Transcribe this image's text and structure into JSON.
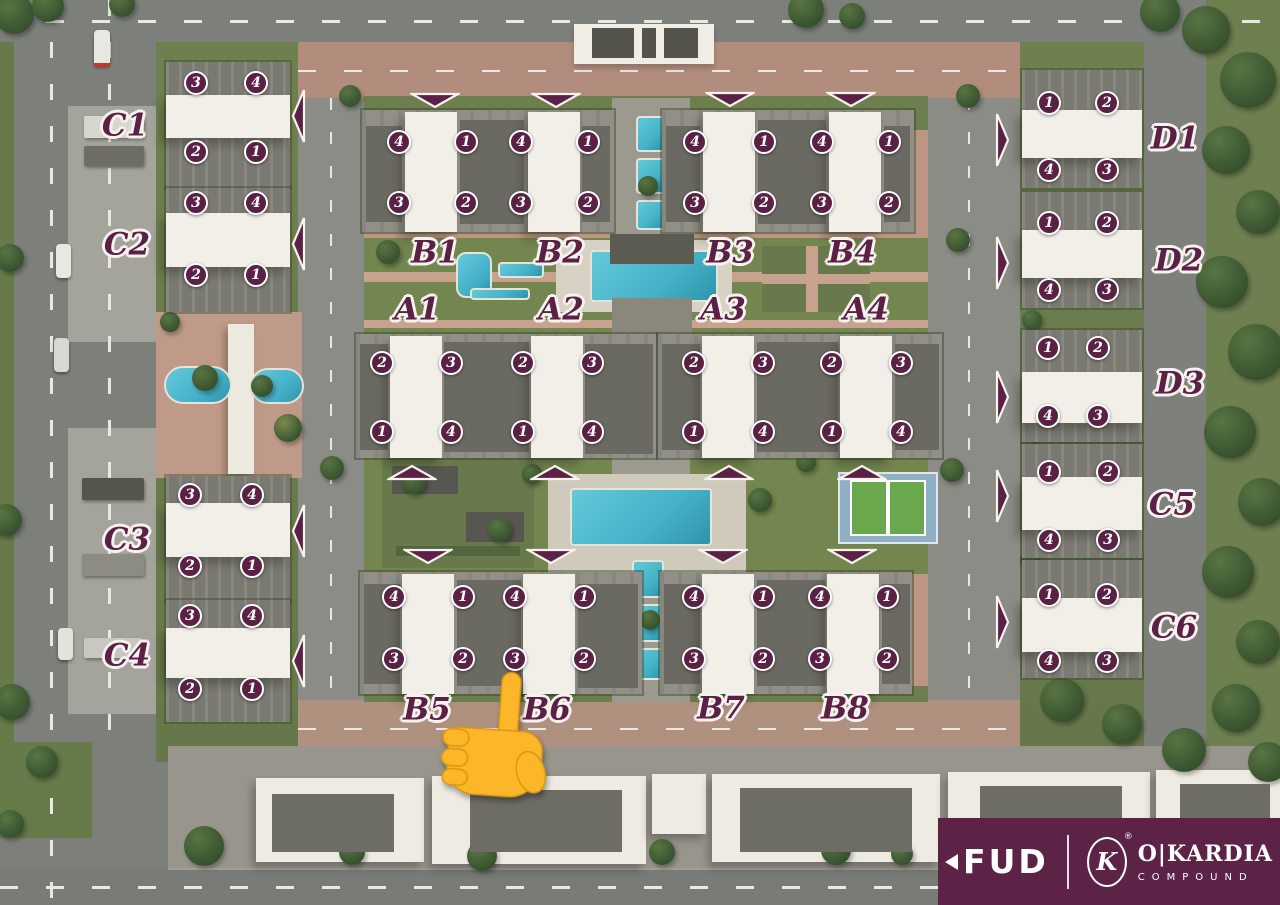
{
  "title": "O|Kardia Compound site master plan",
  "colors": {
    "marker_bg": "#5a2145",
    "marker_text": "#ffffff",
    "label_text": "#5b2045",
    "label_outline": "#f6f3ee",
    "arrow_fill": "#5b2045",
    "arrow_outline": "#f6f3ee",
    "logo_bg": "#5c2347",
    "pointer_yellow": "#fbb629",
    "pool_water": "#45b2c8",
    "lawn_green": "#74864f",
    "tennis_green": "#69a84d",
    "tennis_apron_blue": "#8fb0c4",
    "building_white": "#f1efe8",
    "paving_brick": "#bc9585",
    "road_gray": "#7d7f7a"
  },
  "units_order": [
    "top-left",
    "top-right",
    "bottom-left",
    "bottom-right"
  ],
  "buildings": [
    {
      "id": "C1",
      "label": "C1",
      "units": [
        "3",
        "4",
        "2",
        "1"
      ],
      "entrance_arrow": "left"
    },
    {
      "id": "C2",
      "label": "C2",
      "units": [
        "3",
        "4",
        "2",
        "1"
      ],
      "entrance_arrow": "left"
    },
    {
      "id": "C3",
      "label": "C3",
      "units": [
        "3",
        "4",
        "2",
        "1"
      ],
      "entrance_arrow": "left"
    },
    {
      "id": "C4",
      "label": "C4",
      "units": [
        "3",
        "4",
        "2",
        "1"
      ],
      "entrance_arrow": "left"
    },
    {
      "id": "B1",
      "label": "B1",
      "units": [
        "4",
        "1",
        "3",
        "2"
      ],
      "entrance_arrow": "down"
    },
    {
      "id": "B2",
      "label": "B2",
      "units": [
        "4",
        "1",
        "3",
        "2"
      ],
      "entrance_arrow": "down"
    },
    {
      "id": "B3",
      "label": "B3",
      "units": [
        "4",
        "1",
        "3",
        "2"
      ],
      "entrance_arrow": "down"
    },
    {
      "id": "B4",
      "label": "B4",
      "units": [
        "4",
        "1",
        "3",
        "2"
      ],
      "entrance_arrow": "down"
    },
    {
      "id": "A1",
      "label": "A1",
      "units": [
        "2",
        "3",
        "1",
        "4"
      ],
      "entrance_arrow": "up"
    },
    {
      "id": "A2",
      "label": "A2",
      "units": [
        "2",
        "3",
        "1",
        "4"
      ],
      "entrance_arrow": "up"
    },
    {
      "id": "A3",
      "label": "A3",
      "units": [
        "2",
        "3",
        "1",
        "4"
      ],
      "entrance_arrow": "up"
    },
    {
      "id": "A4",
      "label": "A4",
      "units": [
        "2",
        "3",
        "1",
        "4"
      ],
      "entrance_arrow": "up"
    },
    {
      "id": "B5",
      "label": "B5",
      "units": [
        "4",
        "1",
        "3",
        "2"
      ],
      "entrance_arrow": "down"
    },
    {
      "id": "B6",
      "label": "B6",
      "units": [
        "4",
        "1",
        "3",
        "2"
      ],
      "entrance_arrow": "down"
    },
    {
      "id": "B7",
      "label": "B7",
      "units": [
        "4",
        "1",
        "3",
        "2"
      ],
      "entrance_arrow": "down"
    },
    {
      "id": "B8",
      "label": "B8",
      "units": [
        "4",
        "1",
        "3",
        "2"
      ],
      "entrance_arrow": "down"
    },
    {
      "id": "D1",
      "label": "D1",
      "units": [
        "1",
        "2",
        "4",
        "3"
      ],
      "entrance_arrow": "right"
    },
    {
      "id": "D2",
      "label": "D2",
      "units": [
        "1",
        "2",
        "4",
        "3"
      ],
      "entrance_arrow": "right"
    },
    {
      "id": "D3",
      "label": "D3",
      "units": [
        "1",
        "2",
        "4",
        "3"
      ],
      "entrance_arrow": "right"
    },
    {
      "id": "C5",
      "label": "C5",
      "units": [
        "1",
        "2",
        "4",
        "3"
      ],
      "entrance_arrow": "right"
    },
    {
      "id": "C6",
      "label": "C6",
      "units": [
        "1",
        "2",
        "4",
        "3"
      ],
      "entrance_arrow": "right"
    }
  ],
  "pointer": {
    "icon": "finger-pointing-up",
    "near": "B5 / B6 labels"
  },
  "logo": {
    "developer": "FUD",
    "monogram": "K",
    "registered": "®",
    "name": "O|KARDIA",
    "subtitle": "COMPOUND"
  }
}
